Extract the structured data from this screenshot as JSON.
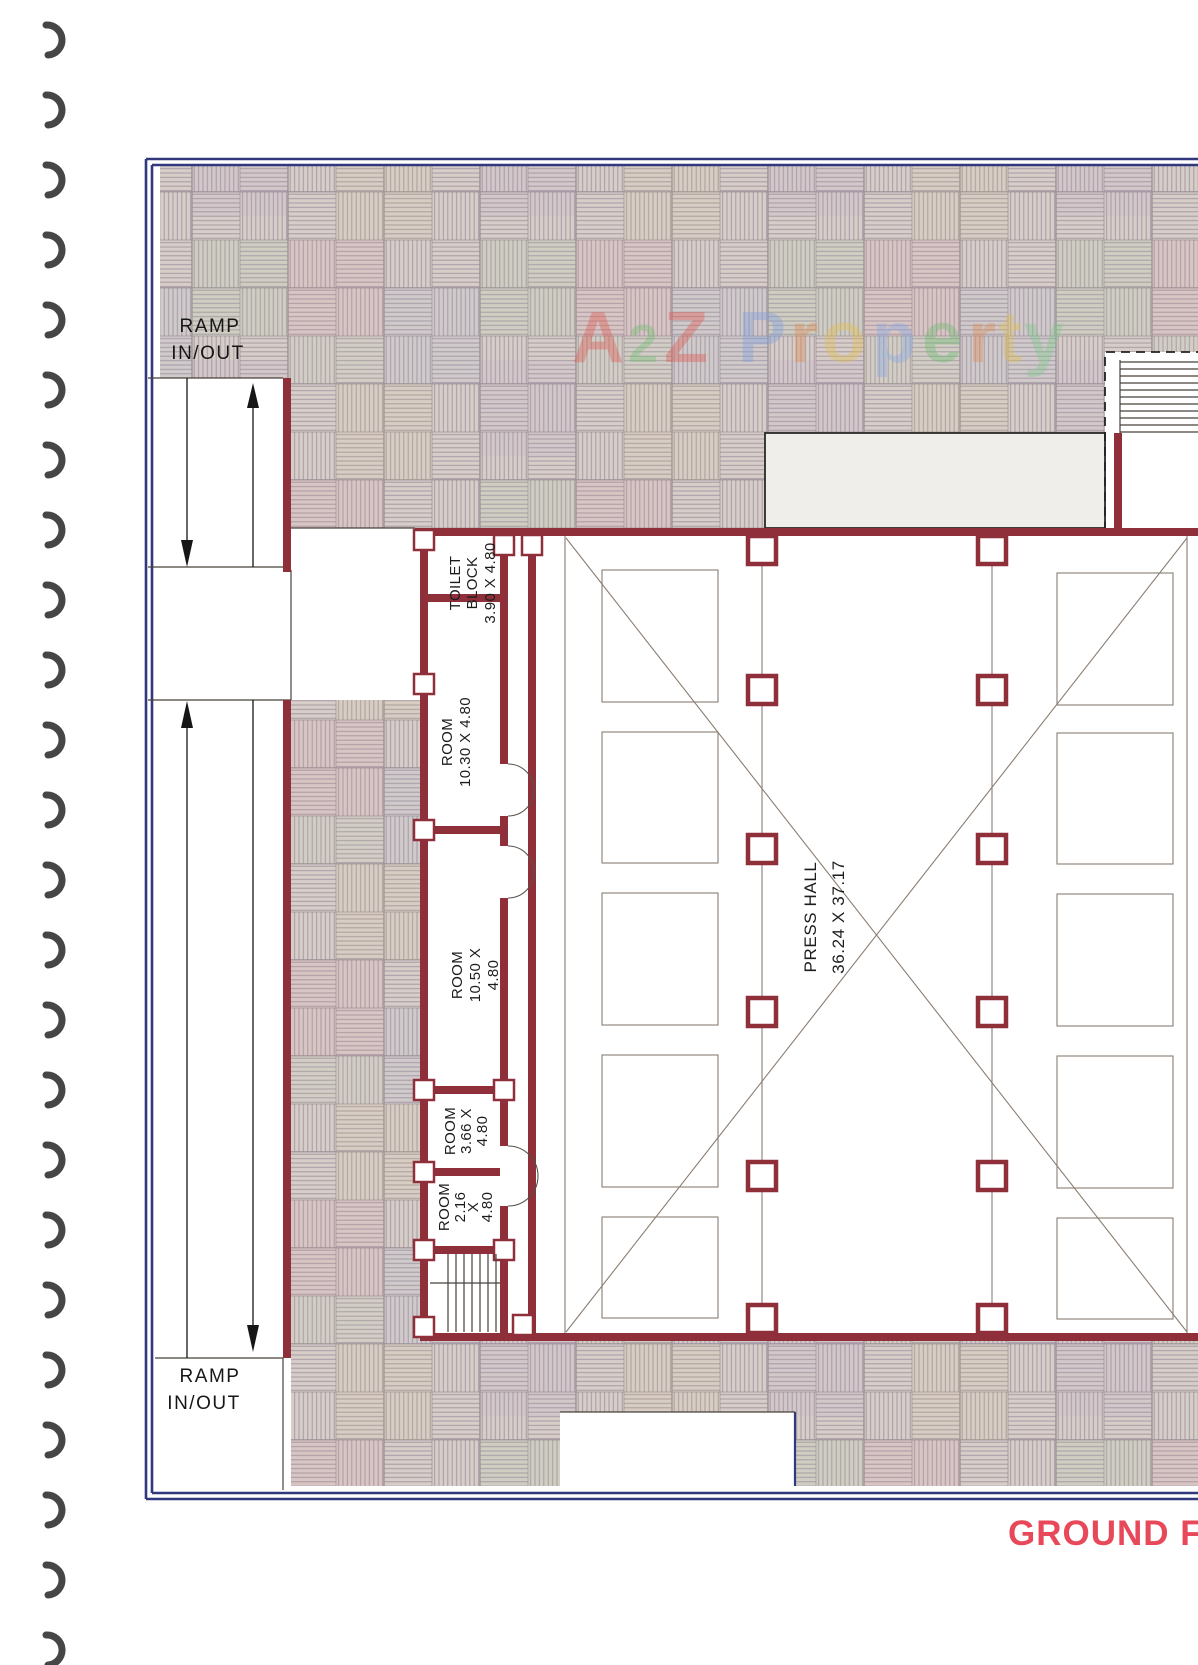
{
  "watermark": {
    "word1": {
      "letters": [
        {
          "ch": "A",
          "color": "#e0574d"
        },
        {
          "ch": "2",
          "color": "#6fbf73"
        },
        {
          "ch": "Z",
          "color": "#e0574d"
        }
      ]
    },
    "word2": {
      "letters": [
        {
          "ch": "P",
          "color": "#7f9fe0"
        },
        {
          "ch": "r",
          "color": "#e08a50"
        },
        {
          "ch": "o",
          "color": "#e4bf4d"
        },
        {
          "ch": "p",
          "color": "#85a9e8"
        },
        {
          "ch": "e",
          "color": "#69bd6e"
        },
        {
          "ch": "r",
          "color": "#e08a50"
        },
        {
          "ch": "t",
          "color": "#e4bf4d"
        },
        {
          "ch": "y",
          "color": "#7fc98a"
        }
      ]
    }
  },
  "plan_title": {
    "text": "GROUND FL",
    "color": "#e8495a"
  },
  "ramp_top": {
    "line1": "RAMP",
    "line2": "IN/OUT"
  },
  "ramp_bottom": {
    "line1": "RAMP",
    "line2": "IN/OUT"
  },
  "rooms": {
    "toilet": {
      "line1": "TOILET",
      "line2": "BLOCK",
      "line3": "3.90 X 4.80"
    },
    "room_1030": {
      "line1": "ROOM",
      "line2": "10.30 X 4.80"
    },
    "room_1050": {
      "line1": "ROOM",
      "line2": "10.50 X",
      "line3": "4.80"
    },
    "room_366": {
      "line1": "ROOM",
      "line2": "3.66 X",
      "line3": "4.80"
    },
    "room_216": {
      "line1": "ROOM",
      "line2": "2.16",
      "line3": "X",
      "line4": "4.80"
    },
    "press_hall": {
      "line1": "PRESS HALL",
      "line2": "36.24 X 37.17"
    }
  },
  "colors": {
    "wall": "#8e2f3a",
    "border_blue": "#31387d",
    "hatch_bg": "#d7cec9",
    "hatch_line": "#a79aa3",
    "title_red": "#e8495a"
  }
}
